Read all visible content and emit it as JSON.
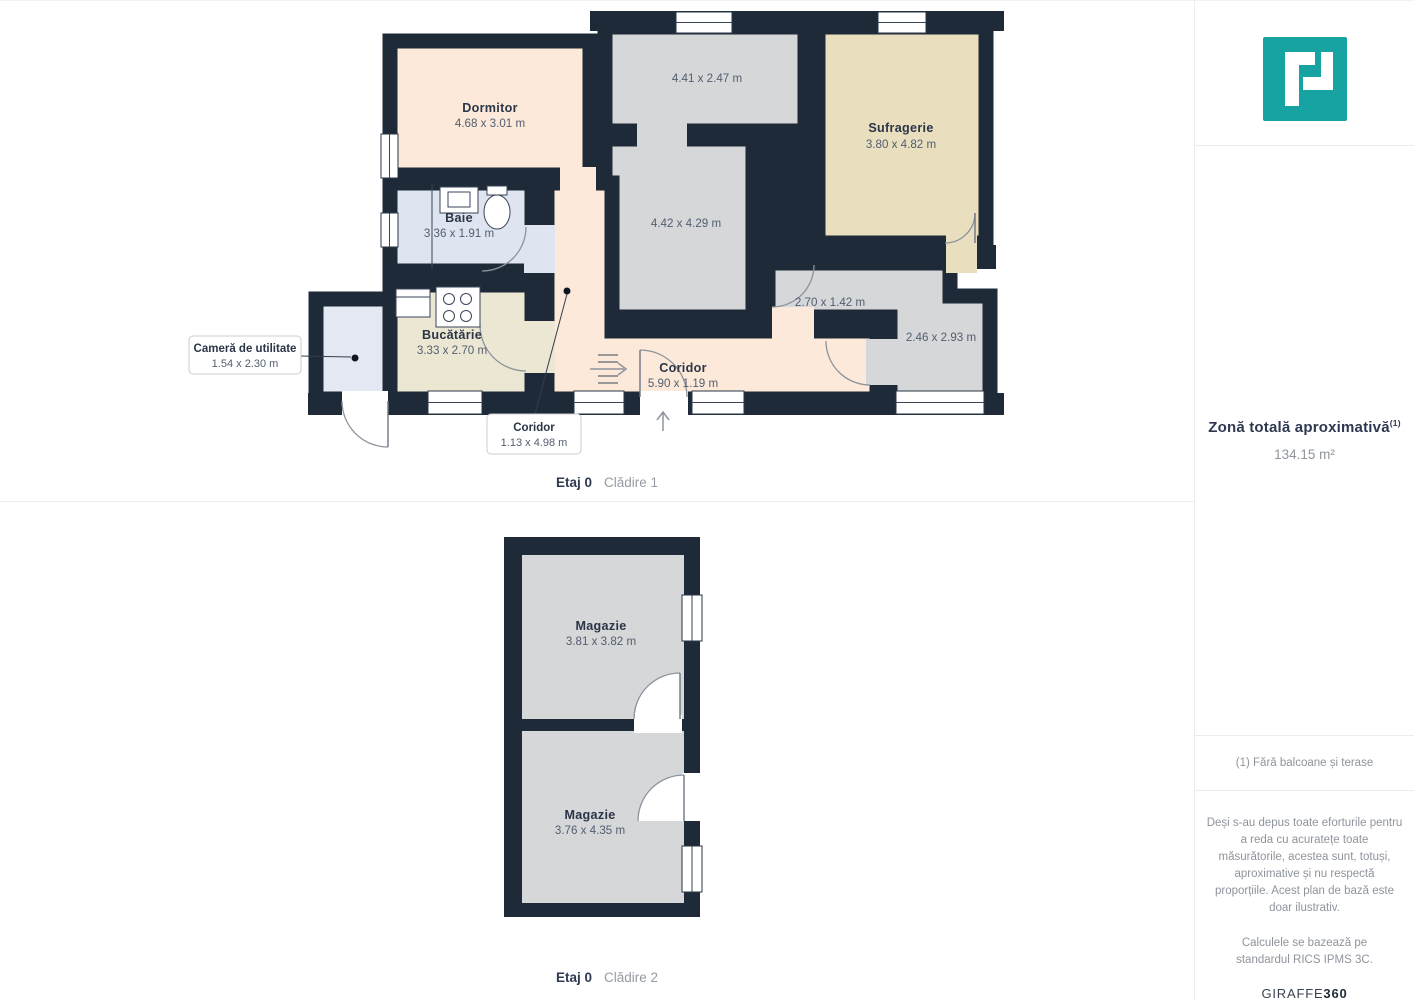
{
  "plans": [
    {
      "caption_floor": "Etaj 0",
      "caption_building": "Clădire 1",
      "rooms": [
        {
          "name": "Dormitor",
          "dims": "4.68 x 3.01 m"
        },
        {
          "name": "",
          "dims": "4.41 x 2.47 m"
        },
        {
          "name": "Sufragerie",
          "dims": "3.80 x 4.82 m"
        },
        {
          "name": "",
          "dims": "4.42 x 4.29 m"
        },
        {
          "name": "Baie",
          "dims": "3.36 x 1.91 m"
        },
        {
          "name": "Bucătărie",
          "dims": "3.33 x 2.70 m"
        },
        {
          "name": "",
          "dims": "2.70 x 1.42 m"
        },
        {
          "name": "",
          "dims": "2.46 x 2.93 m"
        },
        {
          "name": "Coridor",
          "dims": "5.90 x 1.19 m"
        }
      ],
      "callouts": [
        {
          "name": "Cameră de utilitate",
          "dims": "1.54 x 2.30 m"
        },
        {
          "name": "Coridor",
          "dims": "1.13 x 4.98 m"
        }
      ]
    },
    {
      "caption_floor": "Etaj 0",
      "caption_building": "Clădire 2",
      "rooms": [
        {
          "name": "Magazie",
          "dims": "3.81 x 3.82 m"
        },
        {
          "name": "Magazie",
          "dims": "3.76 x 4.35 m"
        }
      ]
    }
  ],
  "sidebar": {
    "logo": "giraffe360-p-logo",
    "total_area_label": "Zonă totală aproximativă",
    "total_area_sup": "(1)",
    "total_area_value": "134.15 m²",
    "footnote": "(1) Fără balcoane și terase",
    "disclaimer": "Deși s-au depus toate eforturile pentru a reda cu acuratețe toate măsurătorile, acestea sunt, totuși, aproximative și nu respectă proporțiile. Acest plan de bază este doar ilustrativ.",
    "standard_note": "Calculele se bazează pe standardul RICS IPMS 3C.",
    "brand": {
      "name": "GIRAFFE",
      "suffix": "360"
    }
  },
  "colors": {
    "accent_teal": "#16a3a1",
    "wall": "#1e2a38",
    "room_peach": "#fce9d9",
    "room_gray": "#d5d7d8",
    "room_tan": "#e9debe",
    "room_blue": "#dee4f0",
    "room_cream": "#ece7d3",
    "room_pale_blue": "#e4e8f2"
  }
}
